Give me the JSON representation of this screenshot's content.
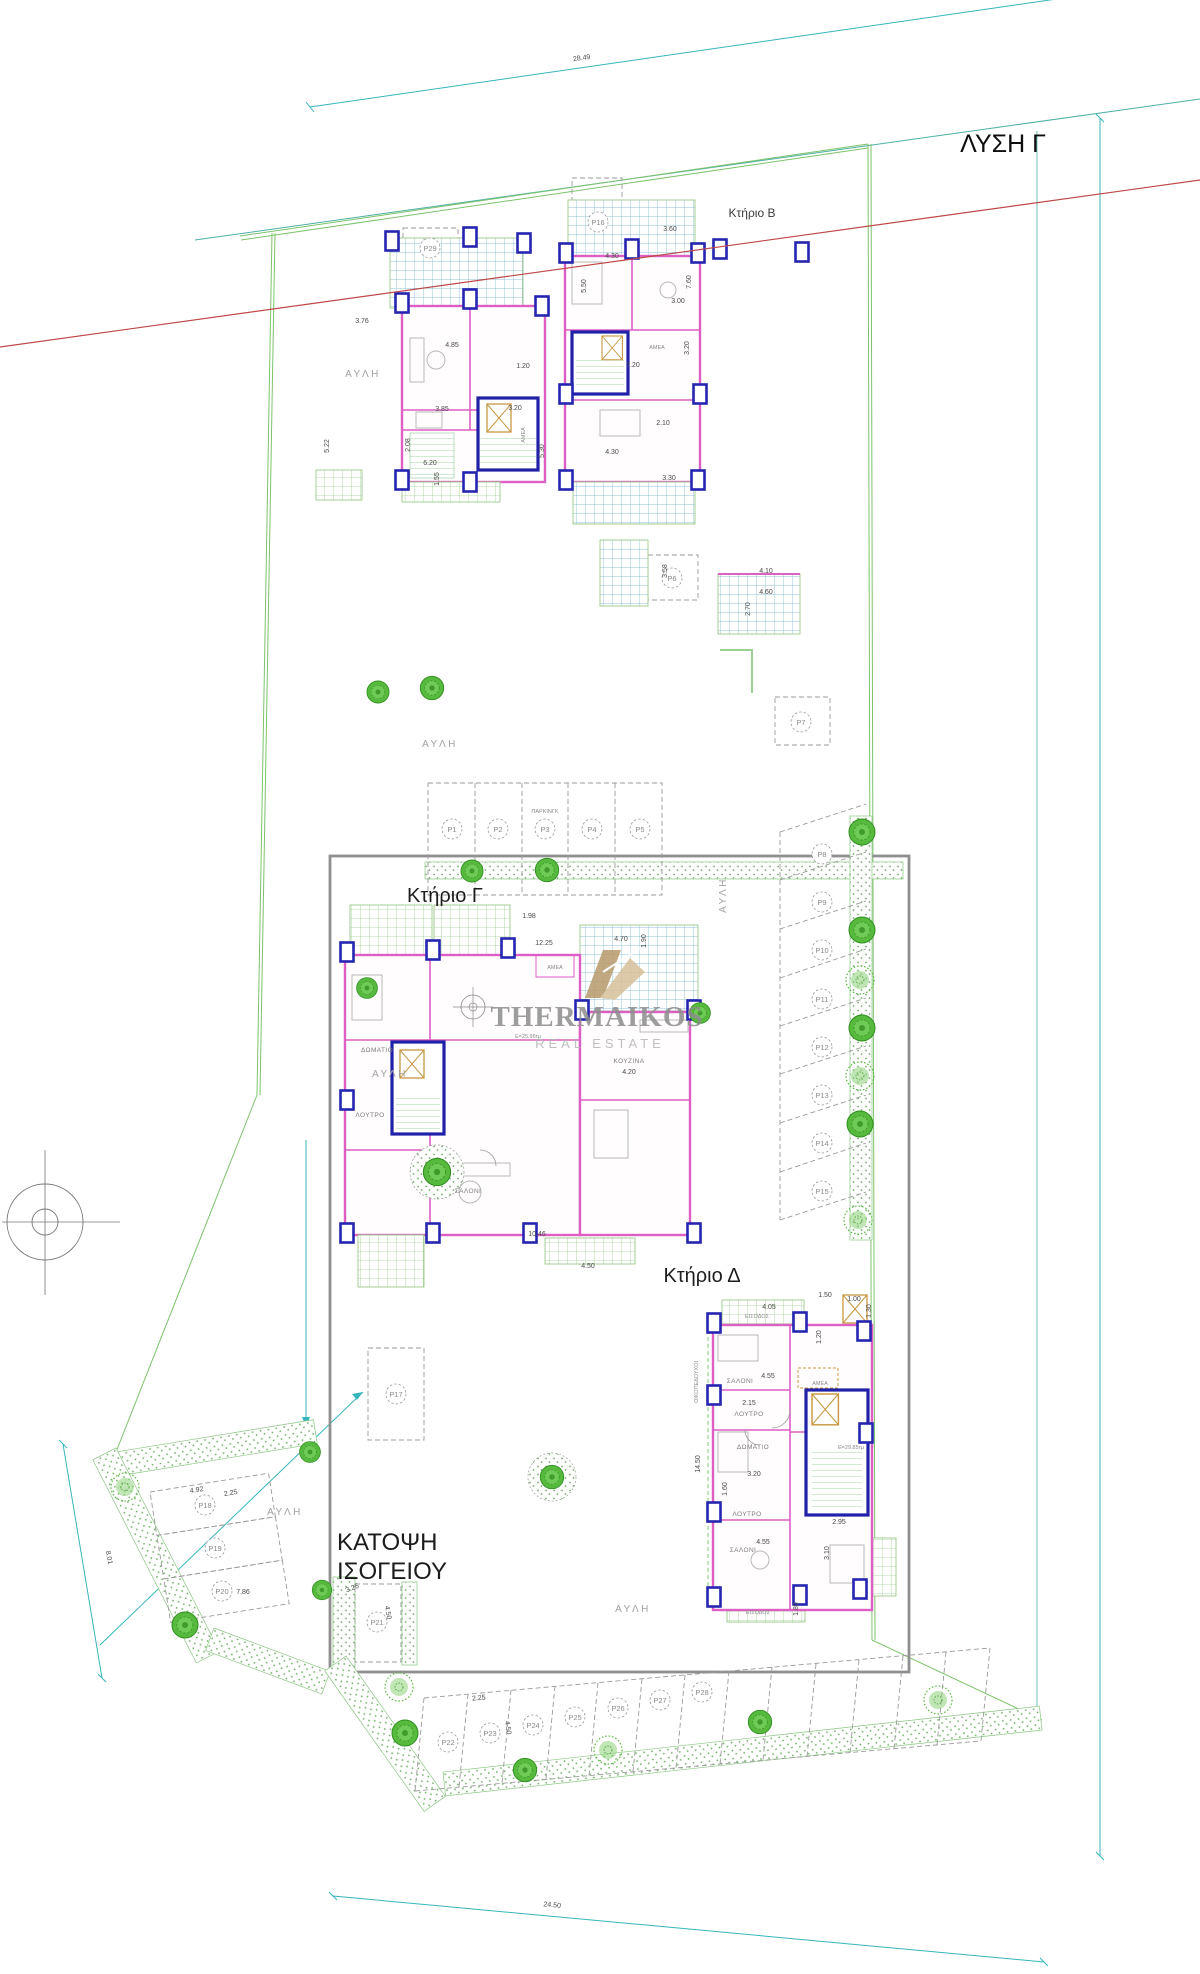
{
  "title": "ΛΥΣΗ Γ",
  "plan_caption": {
    "line1": "ΚΑΤΟΨΗ",
    "line2": "ΙΣΟΓΕΙΟΥ"
  },
  "brand": {
    "name": "THERMAIKOS",
    "tagline": "REAL ESTATE"
  },
  "buildings": {
    "b": "Κτήριο Β",
    "c": "Κτήριο Γ",
    "d": "Κτήριο Δ"
  },
  "labels": {
    "courtyard": "ΑΥΛΗ",
    "parking": "ΠΑΡΚΙΝΓΚ",
    "owners": "ΟΙΚΟΠΕΔΟΥΧΟΙ"
  },
  "rooms": {
    "living": "ΣΑΛΟΝΙ",
    "bedroom": "ΔΩΜΑΤΙΟ",
    "bath": "ΛΟΥΤΡΟ",
    "kitchen": "ΚΟΥΖΙΝΑ",
    "accessible": "ΑΜΕΑ",
    "entrance": "ΕΙΣΟΔΟΣ",
    "area_c": "Ε=25.96τμ",
    "area_d": "Ε=29.85τμ"
  },
  "parking_spots": [
    "P1",
    "P2",
    "P3",
    "P4",
    "P5",
    "P6",
    "P7",
    "P8",
    "P9",
    "P10",
    "P11",
    "P12",
    "P13",
    "P14",
    "P15",
    "P16",
    "P17",
    "P18",
    "P19",
    "P20",
    "P21",
    "P22",
    "P23",
    "P24",
    "P25",
    "P26",
    "P27",
    "P28",
    "P29"
  ],
  "dims": {
    "top_width": "28.49",
    "bottom_width": "24.50",
    "a1": "3.76",
    "a2": "4.85",
    "a3": "3.85",
    "a4": "3.20",
    "a5": "1.20",
    "a6": "6.20",
    "a7": "2.08",
    "a8": "1.55",
    "a9": "5.22",
    "b1": "3.60",
    "b2": "4.30",
    "b3": "5.50",
    "b4": "3.00",
    "b5": "7.20",
    "b6": "2.10",
    "b7": "3.30",
    "b8": "5.30",
    "b9": "3.58",
    "b10": "4.10",
    "b11": "4.60",
    "b12": "2.70",
    "b13": "7.60",
    "b14": "3.20",
    "c1": "12.25",
    "c2": "4.20",
    "c3": "1.98",
    "c4": "4.70",
    "c5": "1.90",
    "c6": "4.50",
    "c7": "10.46",
    "d1": "4.05",
    "d2": "1.50",
    "d3": "1.00",
    "d4": "1.30",
    "d5": "4.55",
    "d6": "2.15",
    "d7": "1.60",
    "d8": "3.20",
    "d9": "14.50",
    "d10": "2.95",
    "d11": "3.10",
    "d12": "1.80",
    "d13": "1.20",
    "w1": "4.92",
    "w2": "2.25",
    "w3": "7.86",
    "w4": "3.25",
    "w5": "4.50",
    "w6": "8.01",
    "s1": "2.25",
    "s2": "4.50"
  },
  "colors": {
    "wall": "#de5fc4",
    "column": "#2020a8",
    "landscape": "#4db335",
    "boundary": "#7dc36b",
    "dimension": "#35b6bc",
    "axis_red": "#bf4848",
    "plot_frame": "#8f8f8f",
    "brand_tan": "#b89a6a"
  }
}
